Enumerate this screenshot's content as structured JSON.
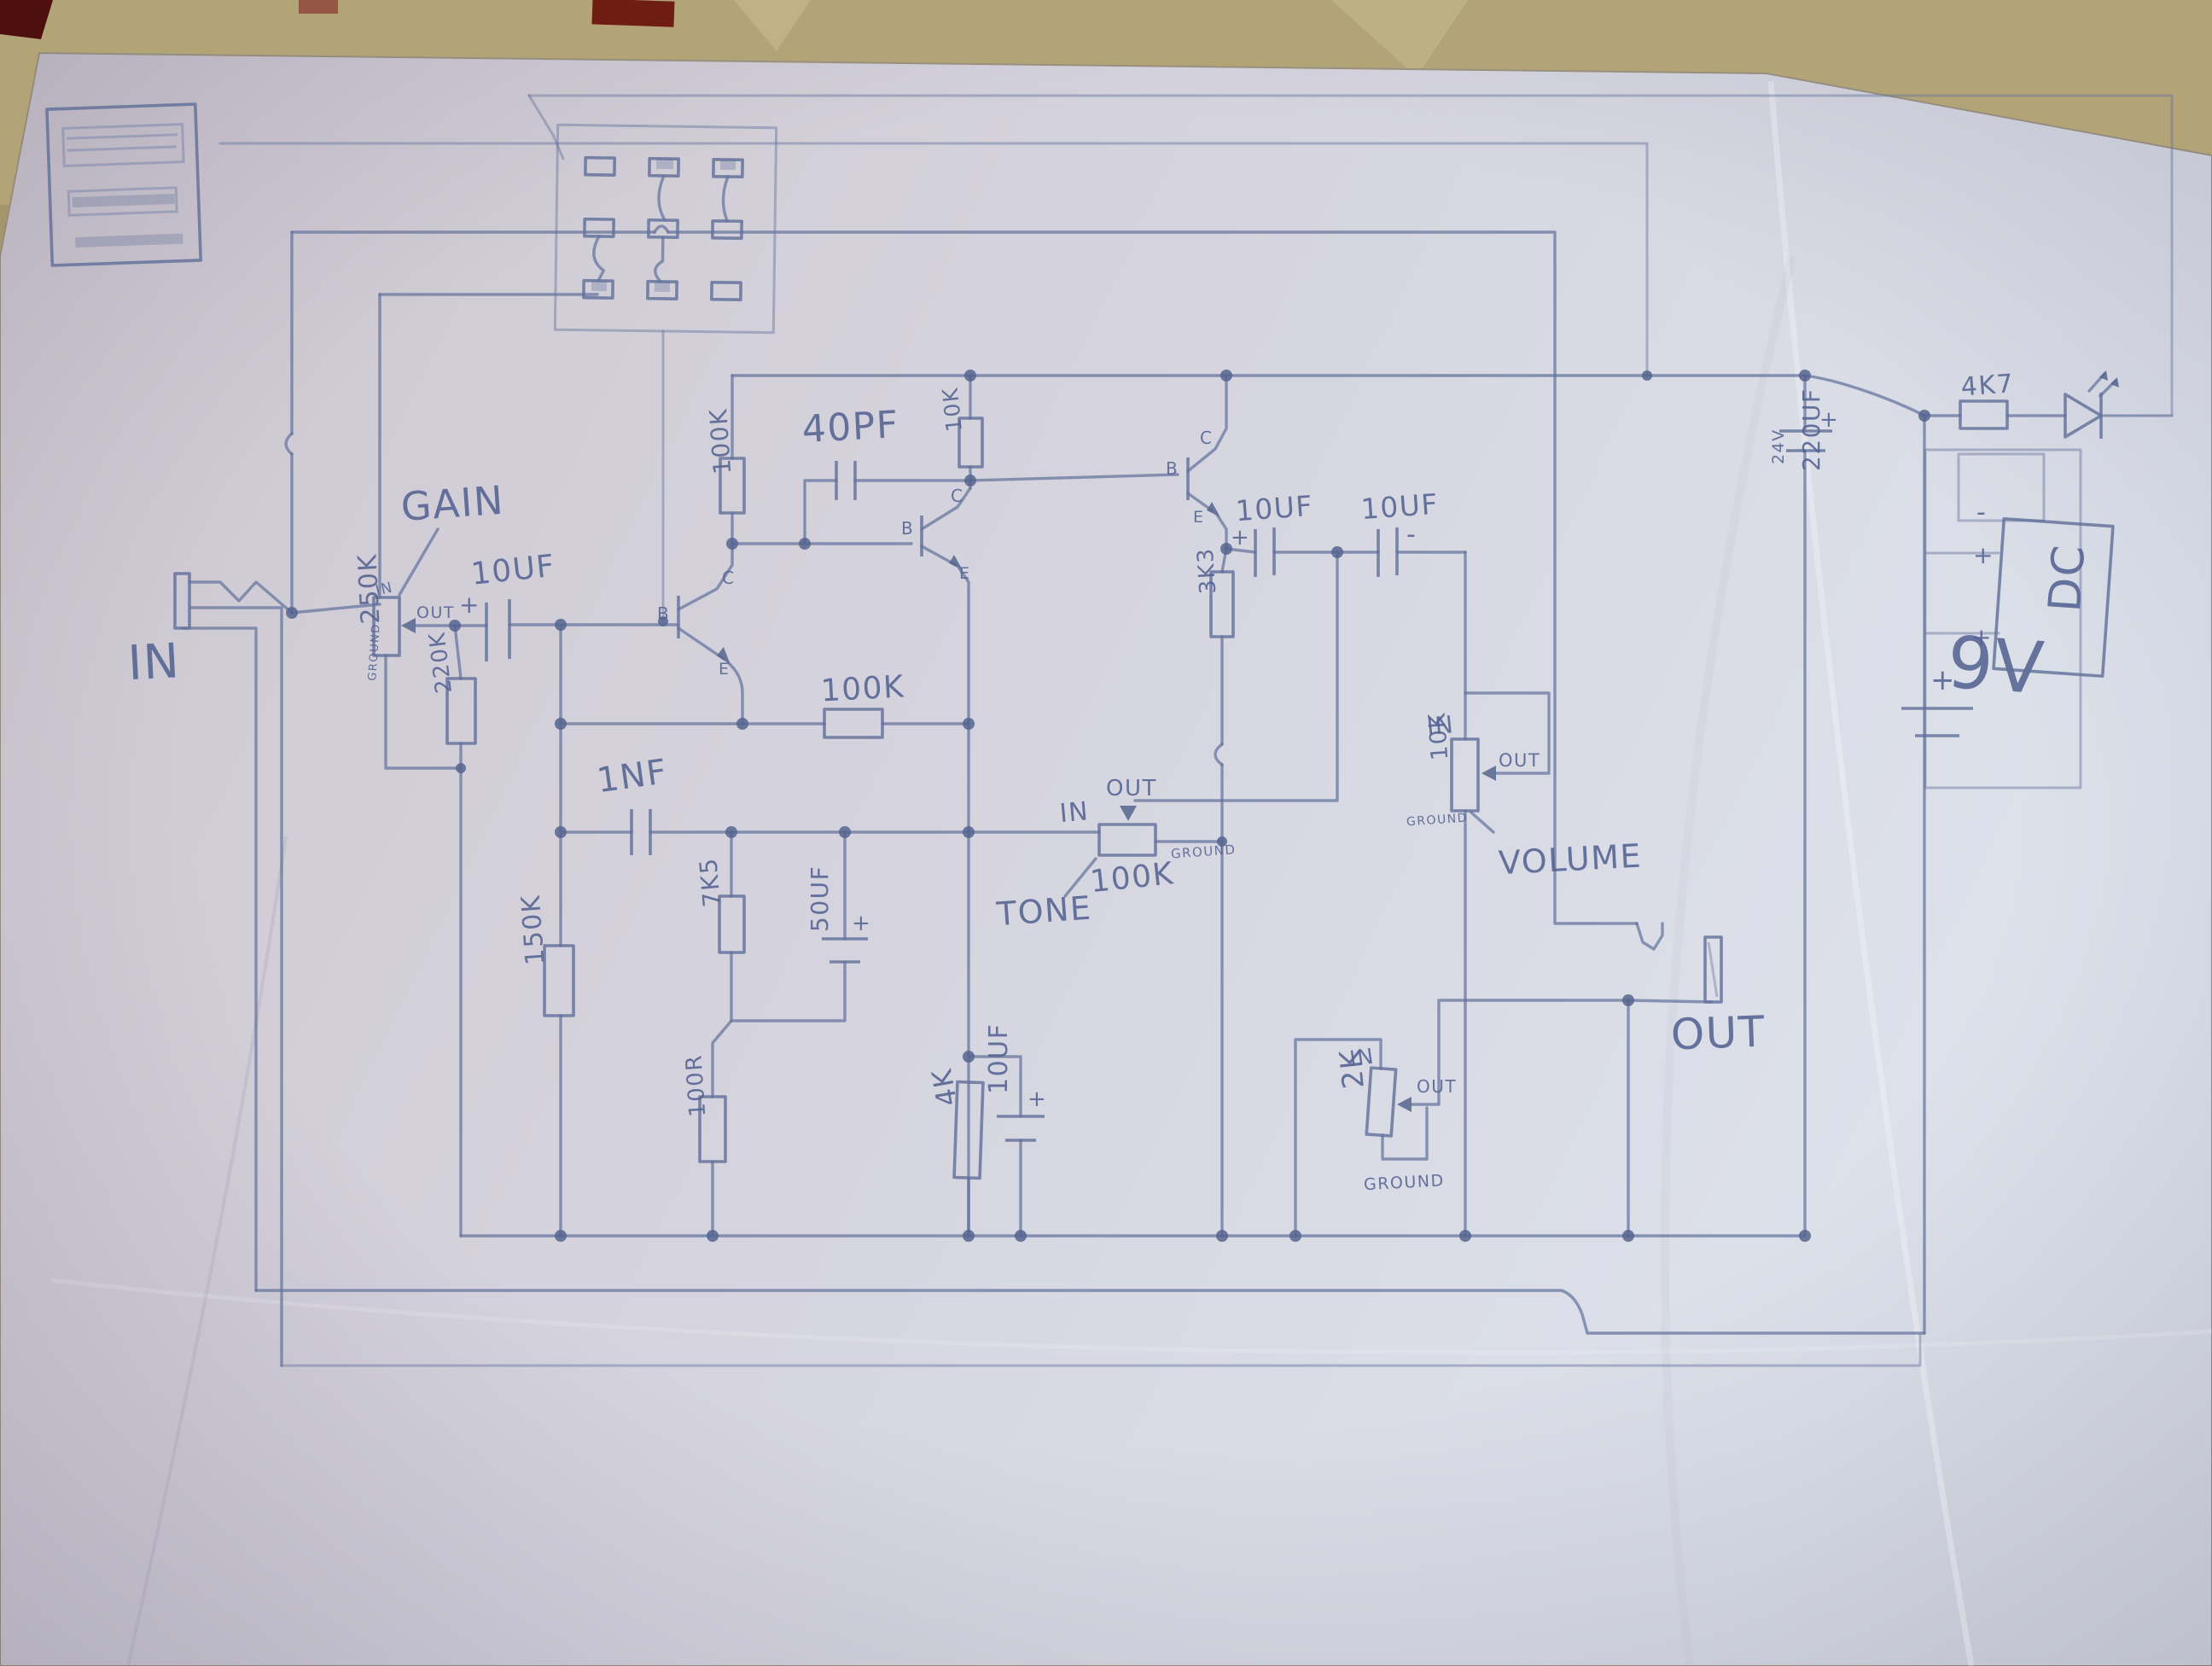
{
  "photo": {
    "table_color": "#ab9c72",
    "paper_color": "#d3d2dc",
    "ink_color": "#64739c"
  },
  "labels": {
    "in_jack": "IN",
    "out_jack": "OUT",
    "gain": "GAIN",
    "tone": "TONE",
    "volume": "VOLUME",
    "gain_pot_value": "250K",
    "gain_pot_in": "IN",
    "gain_pot_out": "OUT",
    "gain_pot_ground": "GROUND",
    "r220k": "220K",
    "cap10uf_in": "10UF",
    "r100k_load": "100K",
    "cap40pf": "40PF",
    "r10k": "10K",
    "r100k_fb": "100K",
    "cap1nf": "1NF",
    "r150k": "150K",
    "r7k5": "7K5",
    "cap50uf": "50UF",
    "r100r": "100R",
    "r4k": "4K",
    "cap10uf_bypass": "10UF",
    "r3k3": "3K3",
    "cap10uf_a": "10UF",
    "cap10uf_b": "10UF",
    "tone_pot_value": "100K",
    "tone_pot_in": "IN",
    "tone_pot_out": "OUT",
    "tone_pot_ground": "GROUND",
    "vol_pot_value": "10K",
    "vol_pot_in": "IN",
    "vol_pot_out": "OUT",
    "vol_pot_ground": "GROUND",
    "p2k_value": "2K",
    "p2k_in": "IN",
    "p2k_out": "OUT",
    "p2k_ground": "GROUND",
    "r4k7": "4K7",
    "cap220uf": "220UF",
    "cap220uf_voltage": "24V",
    "battery": "9V",
    "dc_jack": "DC",
    "q_b": "B",
    "q_c": "C",
    "q_e": "E",
    "plus": "+",
    "minus": "-"
  }
}
